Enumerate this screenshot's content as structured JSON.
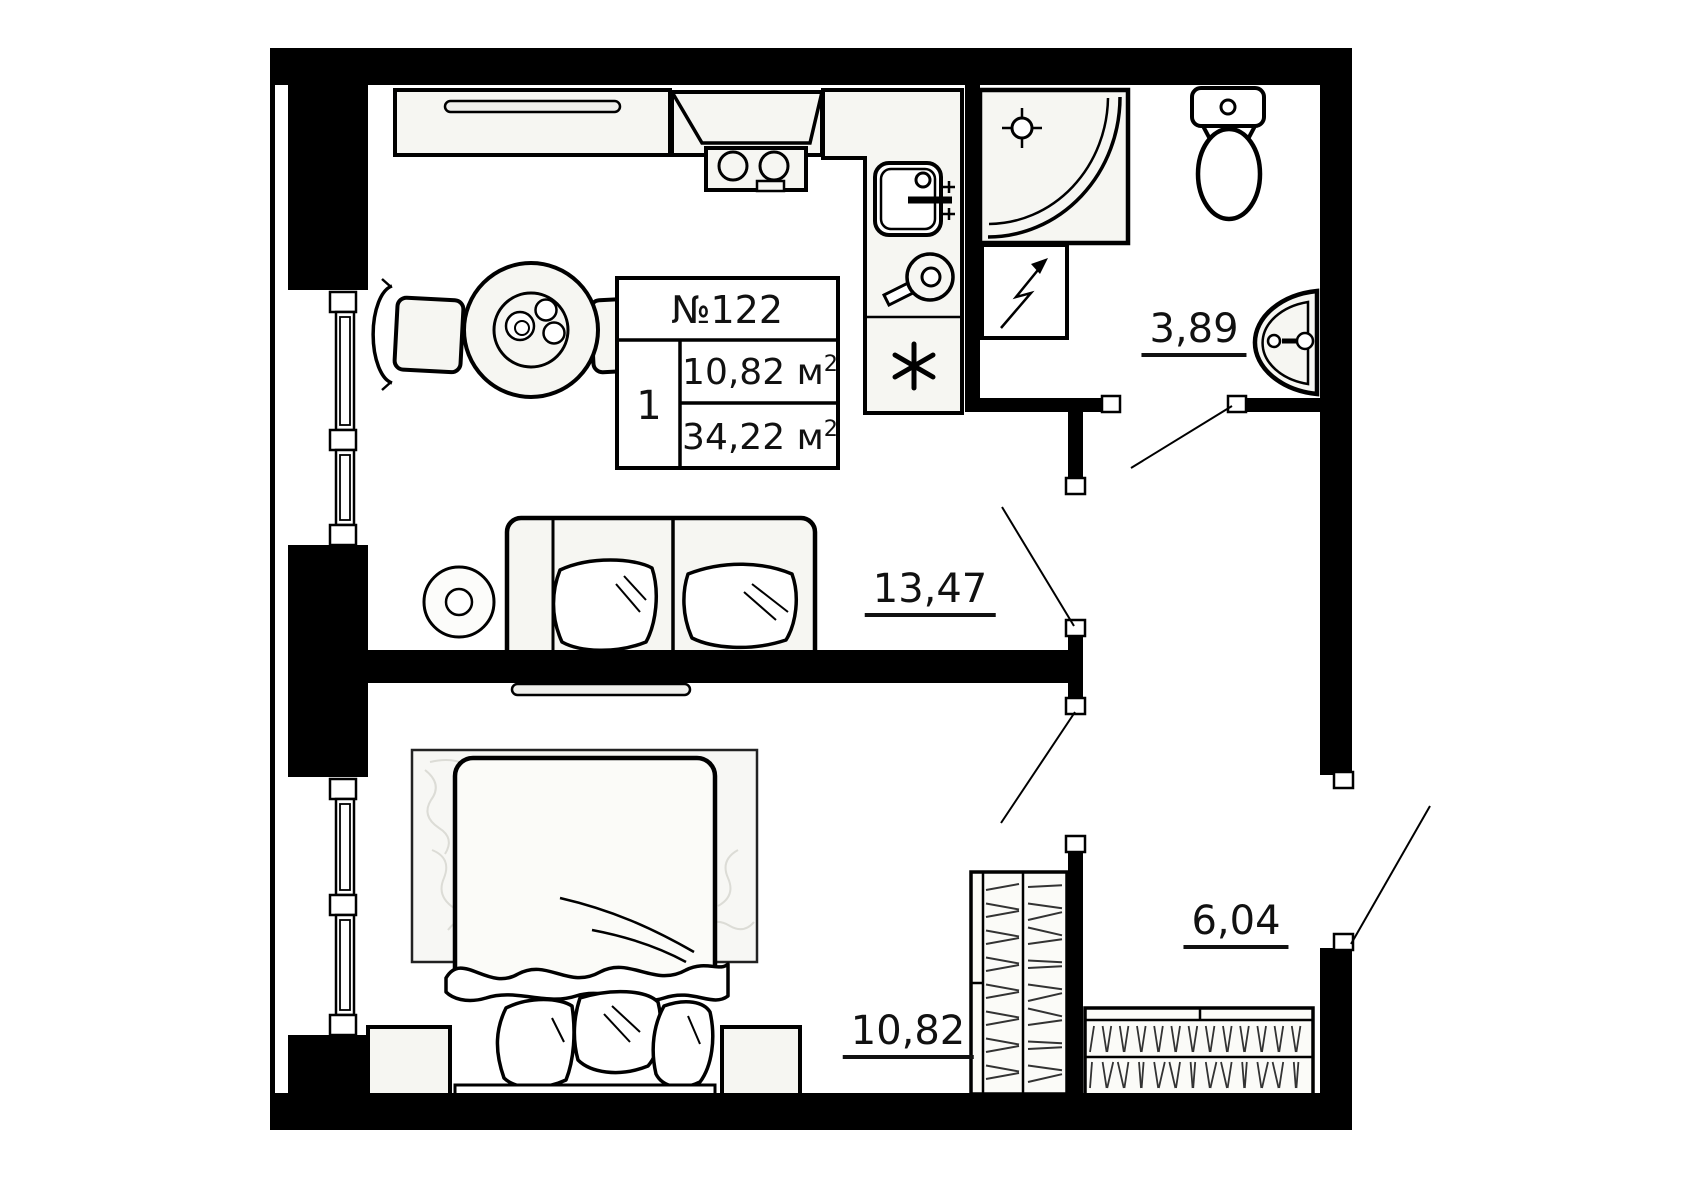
{
  "apartment": {
    "number": "№122",
    "room_count": "1",
    "living_area_value": "10,82",
    "total_area_value": "34,22",
    "area_unit": "м",
    "area_exponent": "2"
  },
  "room_areas": {
    "kitchen_living": "13,47",
    "bathroom": "3,89",
    "hallway": "6,04",
    "bedroom": "10,82"
  },
  "colors": {
    "wall": "#000000",
    "fixture_fill": "#f6f6f2",
    "background": "#ffffff",
    "line": "#000000"
  }
}
